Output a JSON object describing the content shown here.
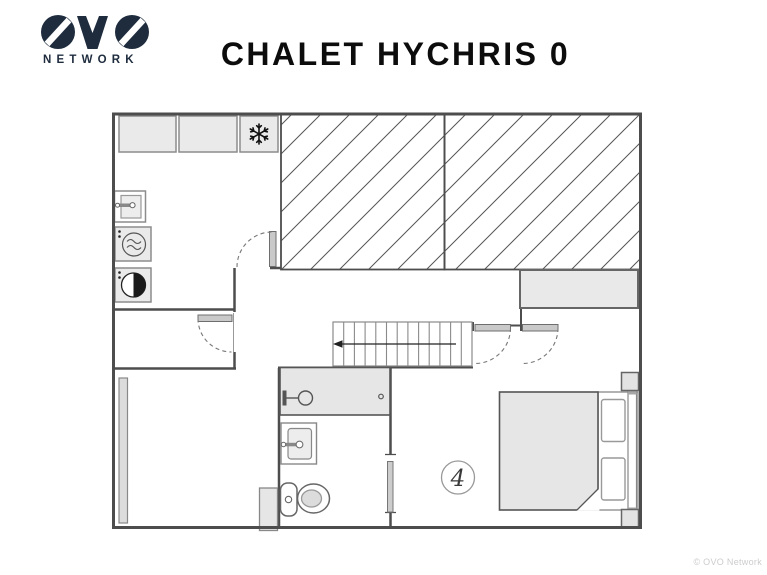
{
  "brand": {
    "logo": "OVO",
    "network": "NETWORK",
    "navy": "#1e2c3e"
  },
  "header": {
    "title": "CHALET HYCHRIS 0"
  },
  "plan": {
    "room_label": "4",
    "fixtures": [
      "kitchen-counter",
      "kitchen-counter",
      "freezer-snowflake-icon",
      "laundry-sink",
      "tumble-dryer-icon",
      "washing-machine-icon",
      "sloped-ceiling-hatch-left",
      "sloped-ceiling-hatch-right",
      "staircase-with-arrow",
      "door-swing-arc",
      "door-swing-arc",
      "door-swing-arc",
      "door-swing-arc",
      "door-leaf",
      "sideboard",
      "window-bar",
      "shower",
      "bathroom-sink",
      "toilet",
      "double-bed",
      "pillow",
      "pillow",
      "bedside-table",
      "bedside-table"
    ],
    "colors": {
      "wall": "#4d4d4d",
      "furniture_fill": "#e9e9e9",
      "soft_fill": "#e6e6e6",
      "door_leaf": "#c9c9c9",
      "hatch_line": "#555555"
    }
  },
  "footer": {
    "copyright": "© OVO Network"
  }
}
